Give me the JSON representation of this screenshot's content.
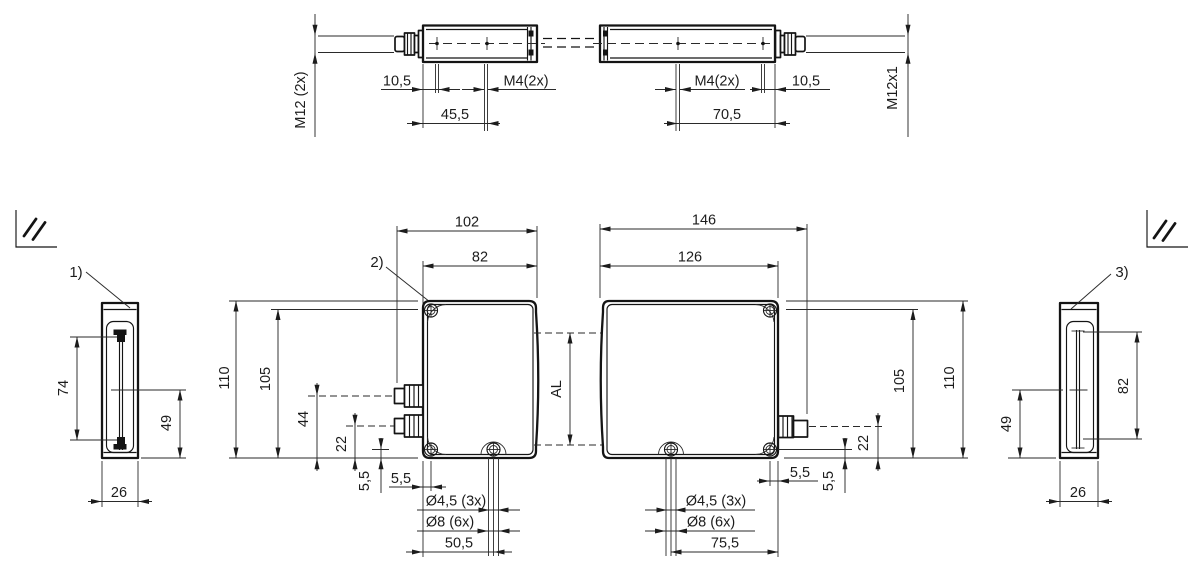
{
  "top_view": {
    "thread_left": "M12 (2x)",
    "offset_left": "10,5",
    "holes_left": "M4(2x)",
    "spacing_left": "45,5",
    "holes_right": "M4(2x)",
    "offset_right": "10,5",
    "spacing_right": "70,5",
    "thread_right": "M12x1"
  },
  "side_left": {
    "label": "1)",
    "window_height": "74",
    "center_offset": "49",
    "depth": "26"
  },
  "front_left": {
    "label": "2)",
    "width_total": "102",
    "width_housing": "82",
    "height_total": "110",
    "height_screw": "105",
    "connector1_offset": "44",
    "connector2_offset": "22",
    "screw_edge_v": "5,5",
    "screw_edge_h": "5,5",
    "hole_small": "Ø4,5 (3x)",
    "hole_large": "Ø8 (6x)",
    "hole_spacing": "50,5"
  },
  "front_right": {
    "active_length": "AL",
    "width_total": "146",
    "width_housing": "126",
    "height_total": "110",
    "height_screw": "105",
    "connector_offset": "22",
    "screw_edge_v": "5,5",
    "screw_edge_h": "5,5",
    "hole_small": "Ø4,5 (3x)",
    "hole_large": "Ø8 (6x)",
    "hole_spacing": "75,5"
  },
  "side_right": {
    "label": "3)",
    "window_height": "82",
    "center_offset": "49",
    "depth": "26"
  }
}
